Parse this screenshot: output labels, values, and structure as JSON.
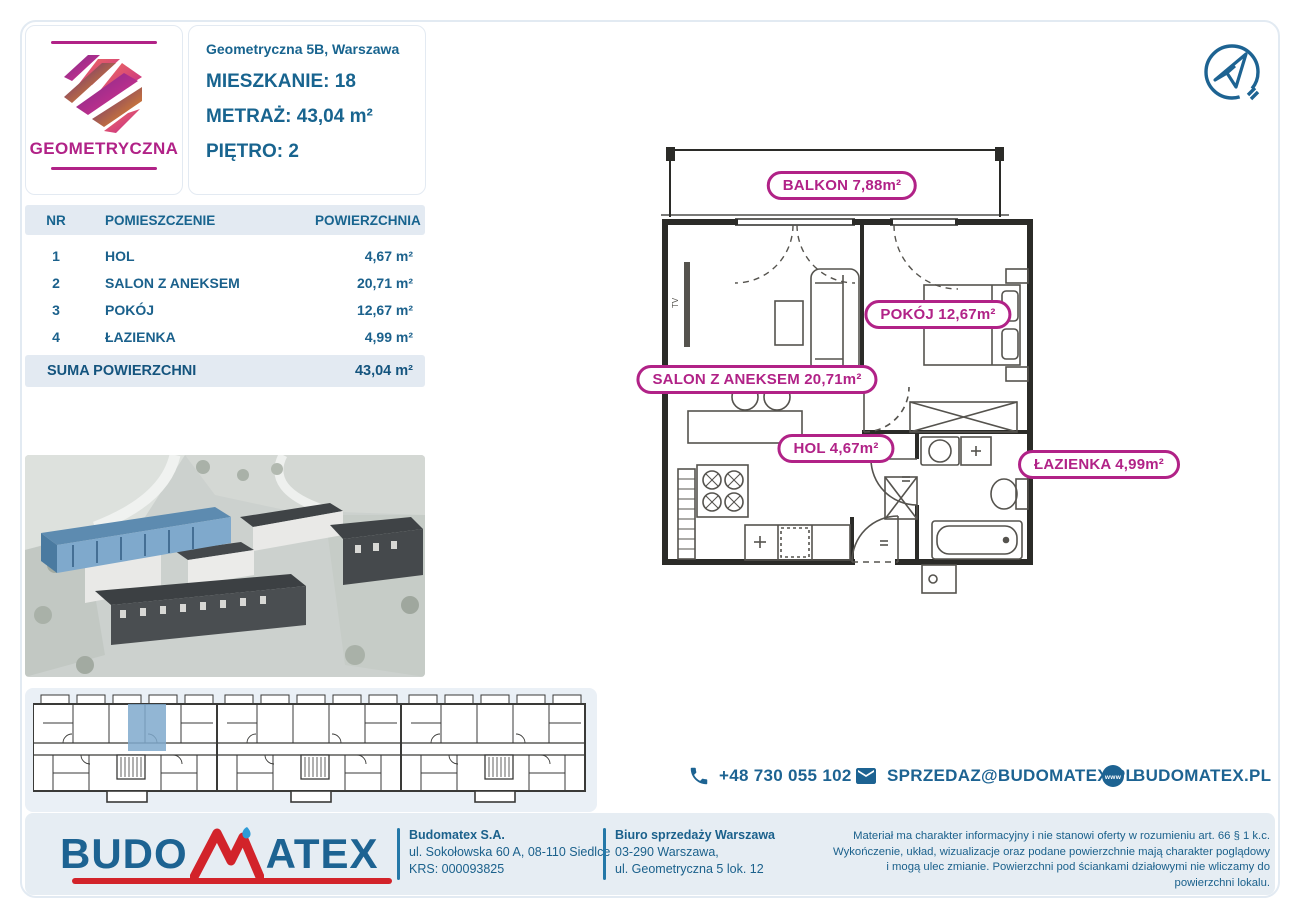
{
  "logo_card": {
    "brand": "GEOMETRYCZNA"
  },
  "header": {
    "address": "Geometryczna 5B, Warszawa",
    "unit_label": "MIESZKANIE:",
    "unit_value": "18",
    "area_label": "METRAŻ:",
    "area_value": "43,04 m²",
    "floor_label": "PIĘTRO:",
    "floor_value": "2"
  },
  "rooms_table": {
    "col_nr": "NR",
    "col_room": "POMIESZCZENIE",
    "col_area": "POWIERZCHNIA",
    "rows": [
      {
        "nr": "1",
        "room": "HOL",
        "area": "4,67 m²"
      },
      {
        "nr": "2",
        "room": "SALON Z ANEKSEM",
        "area": "20,71 m²"
      },
      {
        "nr": "3",
        "room": "POKÓJ",
        "area": "12,67 m²"
      },
      {
        "nr": "4",
        "room": "ŁAZIENKA",
        "area": "4,99 m²"
      }
    ],
    "sum_label": "SUMA POWIERZCHNI",
    "sum_value": "43,04 m²"
  },
  "plan": {
    "labels": {
      "balkon": "BALKON 7,88m²",
      "pokoj": "POKÓJ 12,67m²",
      "salon": "SALON Z ANEKSEM 20,71m²",
      "hol": "HOL 4,67m²",
      "lazienka": "ŁAZIENKA 4,99m²"
    },
    "tv_label": "TV"
  },
  "contact": {
    "phone": "+48 730 055 102",
    "email": "SPRZEDAZ@BUDOMATEX.PL",
    "website": "BUDOMATEX.PL"
  },
  "footer": {
    "brand_left": "BUDO",
    "brand_right": "ATEX",
    "company_name": "Budomatex S.A.",
    "company_address": "ul. Sokołowska 60 A, 08-110 Siedlce",
    "company_krs": "KRS: 000093825",
    "office_name": "Biuro sprzedaży Warszawa",
    "office_line1": "03-290 Warszawa,",
    "office_line2": "ul. Geometryczna 5 lok. 12",
    "disclaimer": "Materiał ma charakter informacyjny i nie stanowi oferty w rozumieniu art. 66 § 1 k.c. Wykończenie, układ, wizualizacje oraz podane powierzchnie mają charakter poglądowy i mogą ulec zmianie. Powierzchni pod ściankami działowymi nie wliczamy do powierzchni lokalu."
  },
  "colors": {
    "blue": "#18648F",
    "magenta": "#B12287",
    "footer_bg": "#E6EDF3",
    "table_header_bg": "#E3EAF2",
    "panel_bg": "#EAF0F6",
    "highlight_blue": "#7FA9CC",
    "logo_red": "#D2232A",
    "logo_blue": "#1D6392"
  }
}
